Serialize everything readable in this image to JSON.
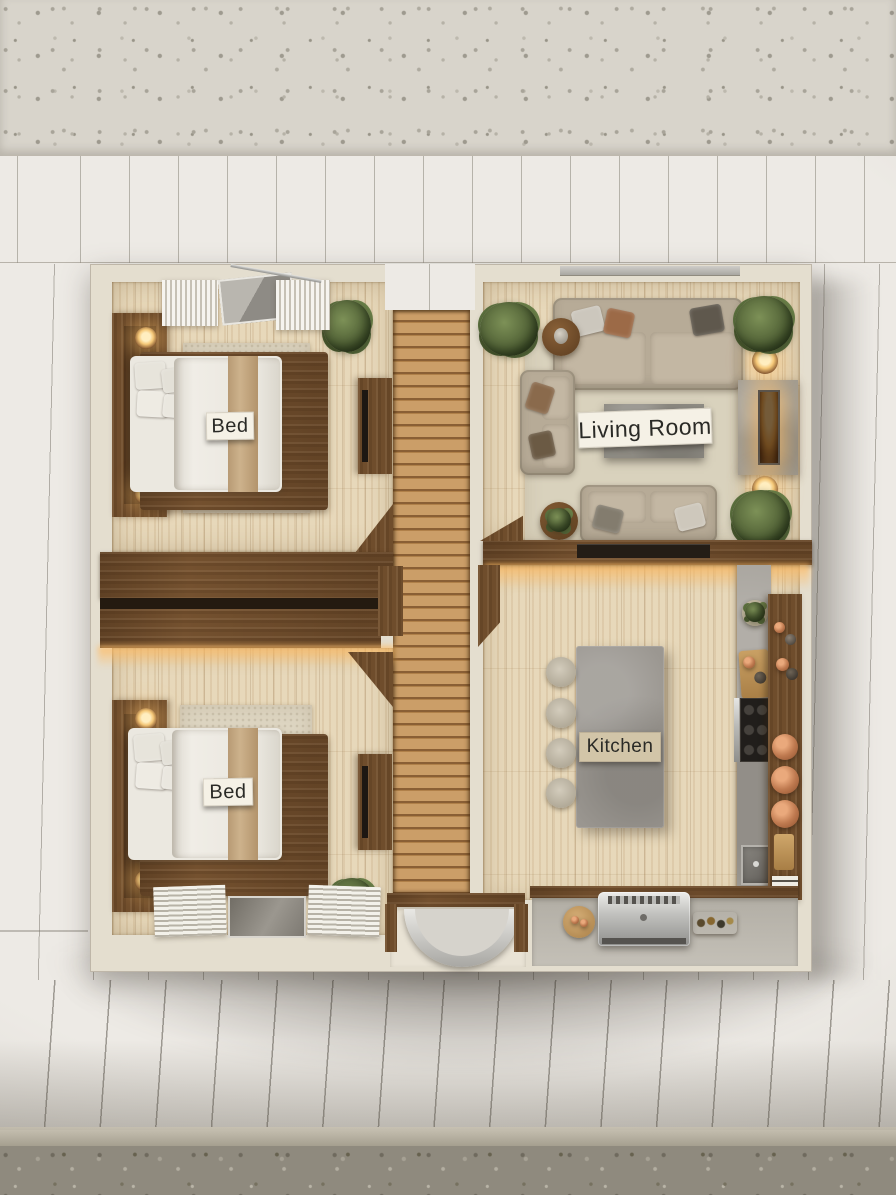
{
  "scene": {
    "description": "Top-down photorealistic 3D floor plan model of a small house placed on a white paneled presentation board with terrazzo flooring visible at the top and bottom edges"
  },
  "labels": {
    "bedroom_top": "Bed",
    "bedroom_bottom": "Bed",
    "living_room": "Living Room",
    "kitchen": "Kitchen"
  },
  "rooms": [
    {
      "id": "bedroom-top",
      "label": "Bed",
      "furniture": [
        "double-bed",
        "walnut-headboard",
        "bedside-lamps",
        "area-rug",
        "plant",
        "tv-console",
        "sheer-curtains",
        "skylight-window"
      ]
    },
    {
      "id": "living-room",
      "label": "Living Room",
      "furniture": [
        "three-seat-sofa",
        "two-seat-sofa",
        "loveseat",
        "coffee-table",
        "round-side-tables",
        "fireplace",
        "table-lamps",
        "potted-plants",
        "woven-rug",
        "flatscreen-tv"
      ]
    },
    {
      "id": "bedroom-bottom",
      "label": "Bed",
      "furniture": [
        "double-bed",
        "walnut-headboard",
        "bedside-lamps",
        "area-rug",
        "plant",
        "tv-console",
        "window-blinds"
      ]
    },
    {
      "id": "kitchen",
      "label": "Kitchen",
      "furniture": [
        "concrete-island",
        "bar-stools",
        "cooktop",
        "oven",
        "sink",
        "cutting-board",
        "copper-pan-rack",
        "herb-pots"
      ]
    },
    {
      "id": "hallway-deck",
      "label": "",
      "furniture": [
        "wood-slat-deck",
        "entry-door-swing-arc",
        "wardrobe-wall"
      ]
    },
    {
      "id": "patio",
      "label": "",
      "furniture": [
        "stainless-bbq-grill",
        "round-serving-board",
        "food-tray"
      ]
    }
  ],
  "palette": {
    "board": "#edeae5",
    "board_line": "#7d786e",
    "terrazzo_top": "#d8d4cb",
    "terrazzo_bottom": "#8f8a7e",
    "wall_cream": "#e4decf",
    "travertine": "#e7d8ba",
    "walnut": "#74512f",
    "deck_wood": "#c2955f",
    "rug": "#ddd5c1",
    "sofa": "#b7ab97",
    "concrete": "#9b9791",
    "copper": "#bf7a50",
    "flame": "#f5c878",
    "glow": "#ffbc64",
    "label_card": "#f5f1e6",
    "label_text": "#2a2a26",
    "steel": "#c6c4bf"
  }
}
